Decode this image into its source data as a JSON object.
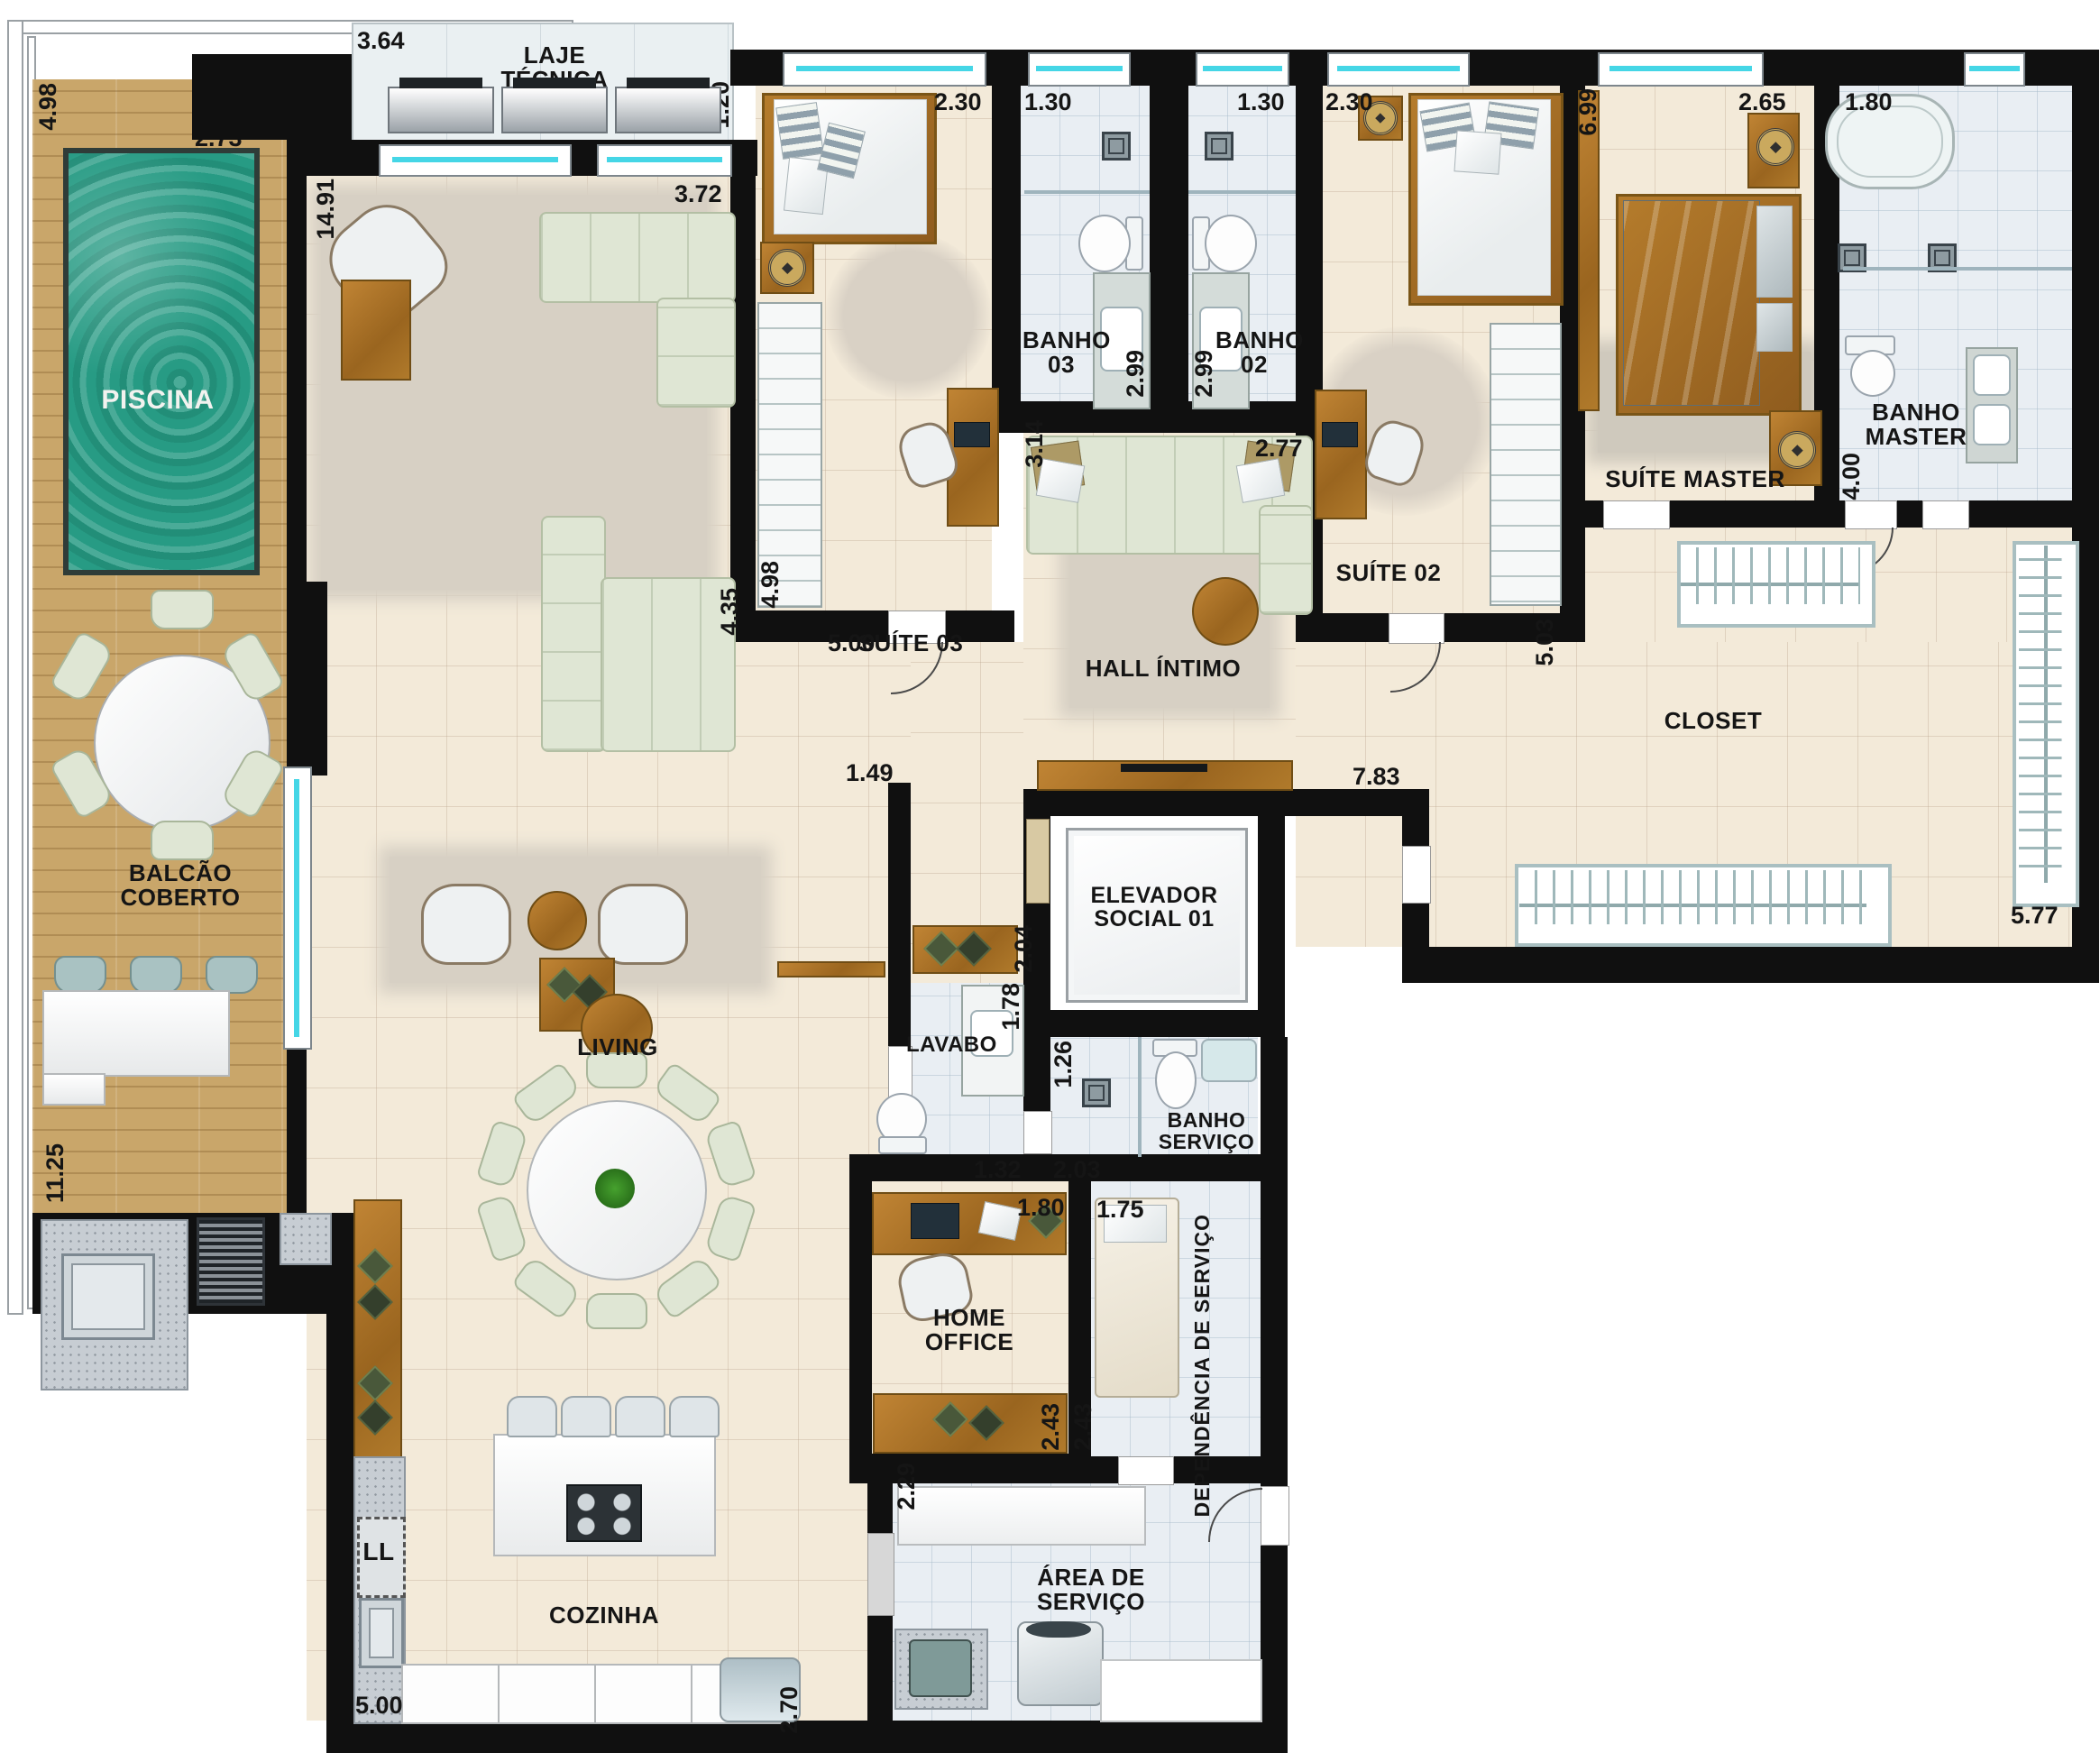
{
  "rooms": {
    "piscina": "PISCINA",
    "laje_tecnica": "LAJE TÉCNICA",
    "suite03": "SUÍTE 03",
    "banho03": "BANHO 03",
    "banho02": "BANHO 02",
    "suite02": "SUÍTE 02",
    "suite_master": "SUÍTE MASTER",
    "banho_master": "BANHO MASTER",
    "hall_intimo": "HALL ÍNTIMO",
    "closet": "CLOSET",
    "balcao_coberto": "BALCÃO COBERTO",
    "living": "LIVING",
    "elevador_social": "ELEVADOR SOCIAL 01",
    "lavabo": "LAVABO",
    "banho_servico": "BANHO SERVIÇO",
    "home_office": "HOME OFFICE",
    "dependencia_servico": "DEPENDÊNCIA DE SERVIÇO",
    "cozinha": "COZINHA",
    "area_servico": "ÁREA DE SERVIÇO",
    "ll": "LL"
  },
  "dims": {
    "laje_w": "3.64",
    "laje_d": "1.20",
    "pool_d": "4.98",
    "pool_w": "2.73",
    "living_len": "14.91",
    "living_w": "3.72",
    "s03_bed_w": "2.30",
    "b03_w": "1.30",
    "b02_w": "1.30",
    "s02_bed_w": "2.30",
    "sm_len": "6.99",
    "sm_w": "2.65",
    "bm_w": "1.80",
    "b03_len": "2.99",
    "b02_len": "2.99",
    "hall_d": "3.14",
    "hall_sofa_w": "2.77",
    "bm_len": "4.00",
    "s03_len": "4.98",
    "living_d": "4.35",
    "s03_w": "5.00",
    "s02_len": "5.03",
    "closet_top_w": "7.83",
    "corridor_w": "1.49",
    "closet_bottom_w": "5.77",
    "balcao_len": "11.25",
    "hall_social_w": "2.04",
    "lavabo_len": "1.78",
    "bs_shower_w": "1.26",
    "lavabo_w": "1.32",
    "bs_w": "2.03",
    "ho_desk_w": "1.80",
    "dep_w": "1.75",
    "ho_w": "2.43",
    "dep_w2": "2.43",
    "area_w": "2.29",
    "koz_w": "5.00",
    "koz_d": "2.70"
  },
  "colors": {
    "wall": "#101010",
    "water": "#279b84",
    "wood": "#a9701f",
    "deck": "#c9a66a",
    "glass": "#45d6e6",
    "floor_tile": "#f3ead9",
    "bath_tile": "#e9eef3",
    "sofa": "#dfe6d4"
  }
}
